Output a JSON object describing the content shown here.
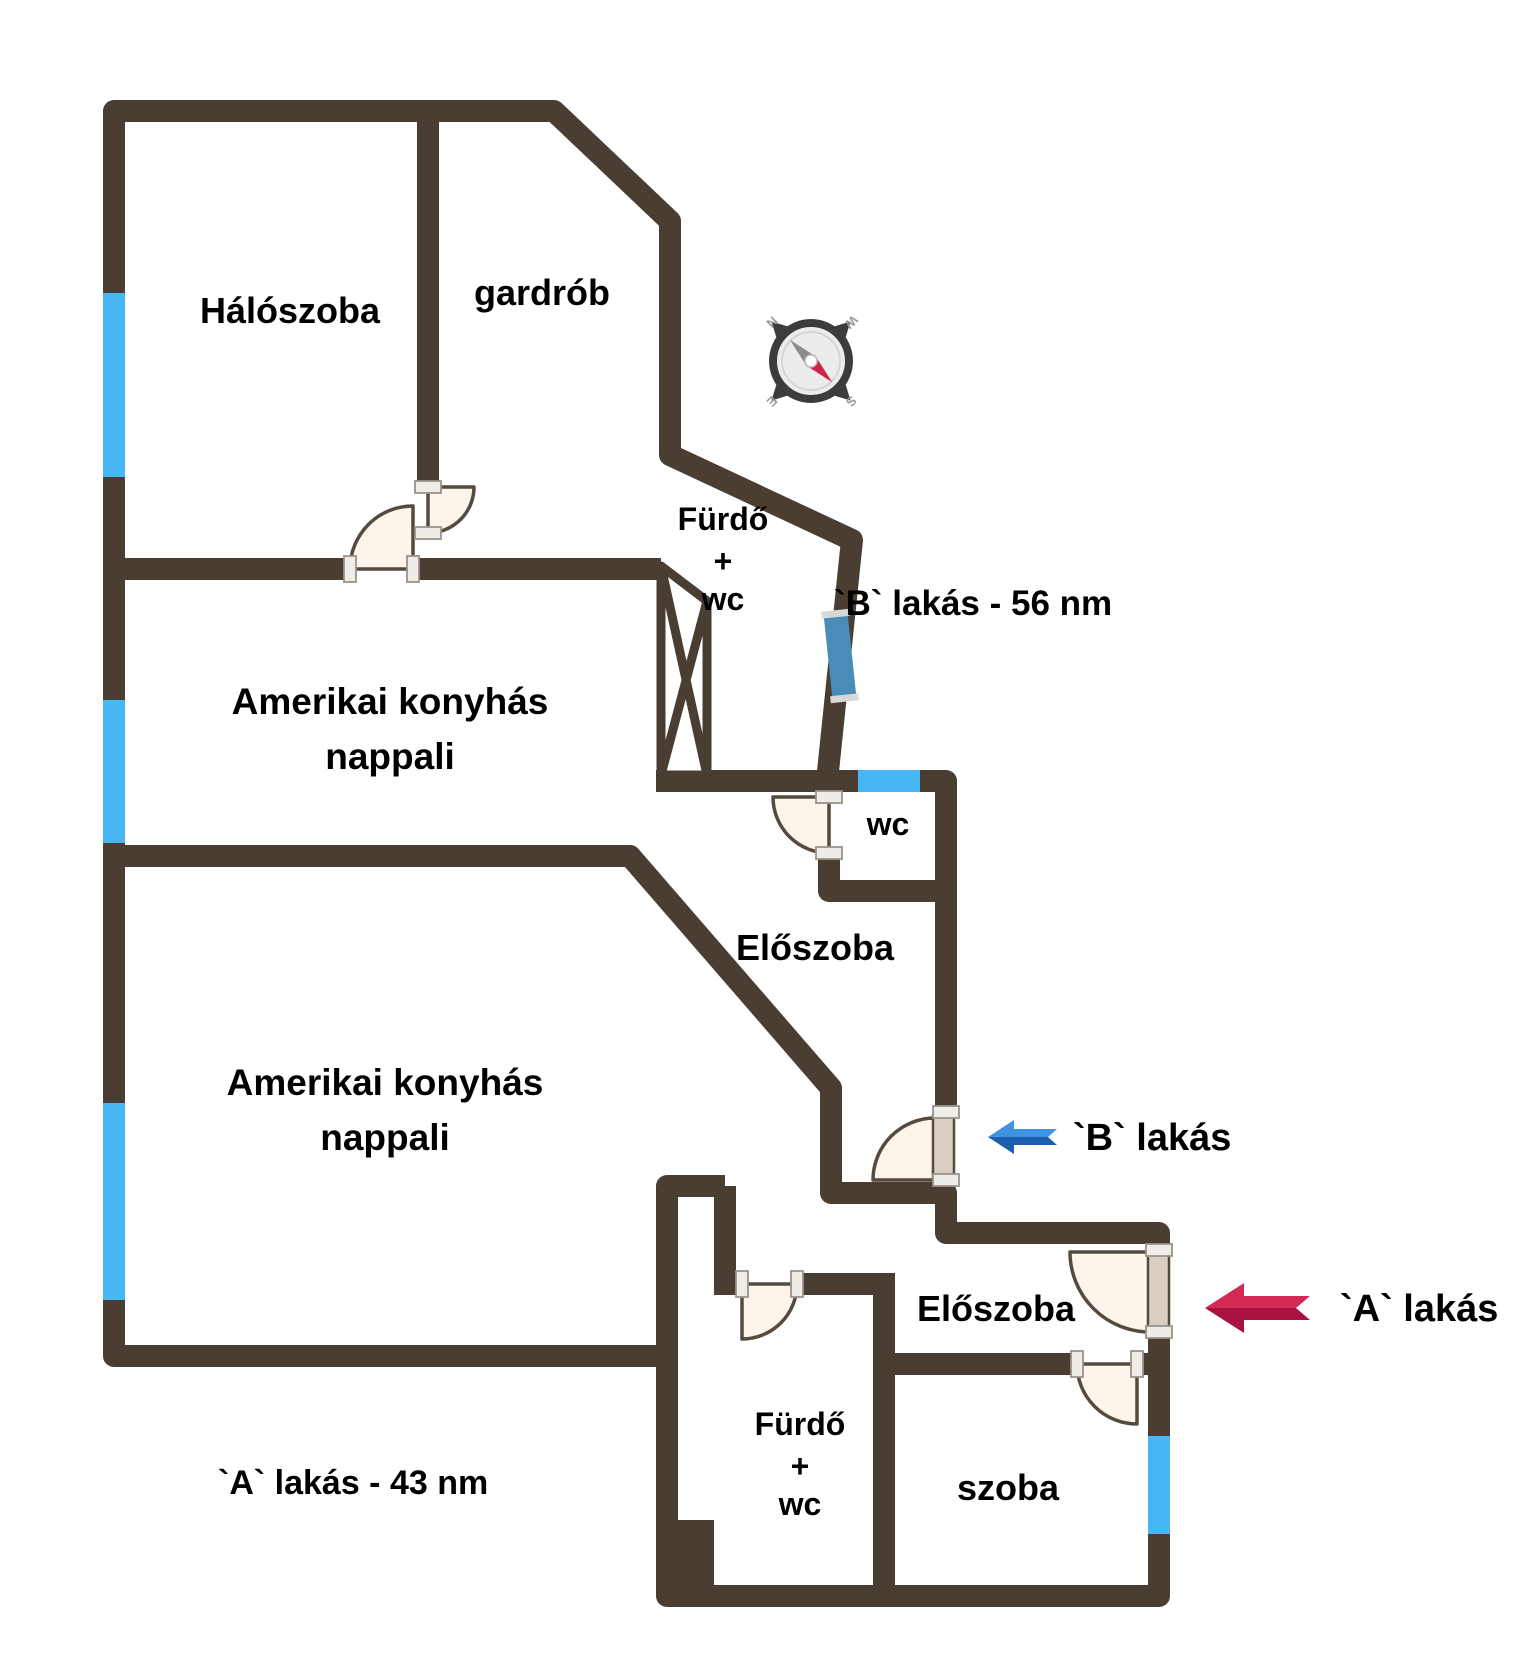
{
  "plan_title": "Two-apartment floor plan",
  "colors": {
    "wall": "#4a3e33",
    "window": "#47b6f5",
    "window_shaded": "#4a8cb8",
    "window_cap": "#d8d8d8",
    "door_fill": "#fdf5ec",
    "door_stroke": "#554a3e",
    "door_leaf": "#d9cfc3",
    "bracket_fill": "#f0ede8",
    "arrow_blue_light": "#3f93e0",
    "arrow_blue_dark": "#1d5fae",
    "arrow_red_light": "#d42a56",
    "arrow_red_dark": "#a81140",
    "compass_ring": "#3c3c3c",
    "compass_face": "#ececec",
    "needle_red": "#cf2449",
    "needle_gray": "#8b8b8b",
    "text": "#000000"
  },
  "apartment_b": {
    "area_label": "`B` lakás - 56 nm",
    "entrance_label": "`B` lakás",
    "rooms": {
      "bedroom": "Hálószoba",
      "wardrobe": "gardrób",
      "bathroom_line1": "Fürdő",
      "bathroom_line2": "+",
      "bathroom_line3": "wc",
      "toilet": "wc",
      "hallway": "Előszoba",
      "living_line1": "Amerikai konyhás",
      "living_line2": "nappali"
    }
  },
  "apartment_a": {
    "area_label": "`A` lakás - 43 nm",
    "entrance_label": "`A` lakás",
    "rooms": {
      "living_line1": "Amerikai konyhás",
      "living_line2": "nappali",
      "hallway": "Előszoba",
      "bathroom_line1": "Fürdő",
      "bathroom_line2": "+",
      "bathroom_line3": "wc",
      "room": "szoba"
    }
  },
  "compass": {
    "north": "N",
    "east": "E",
    "south": "S",
    "west": "W"
  }
}
